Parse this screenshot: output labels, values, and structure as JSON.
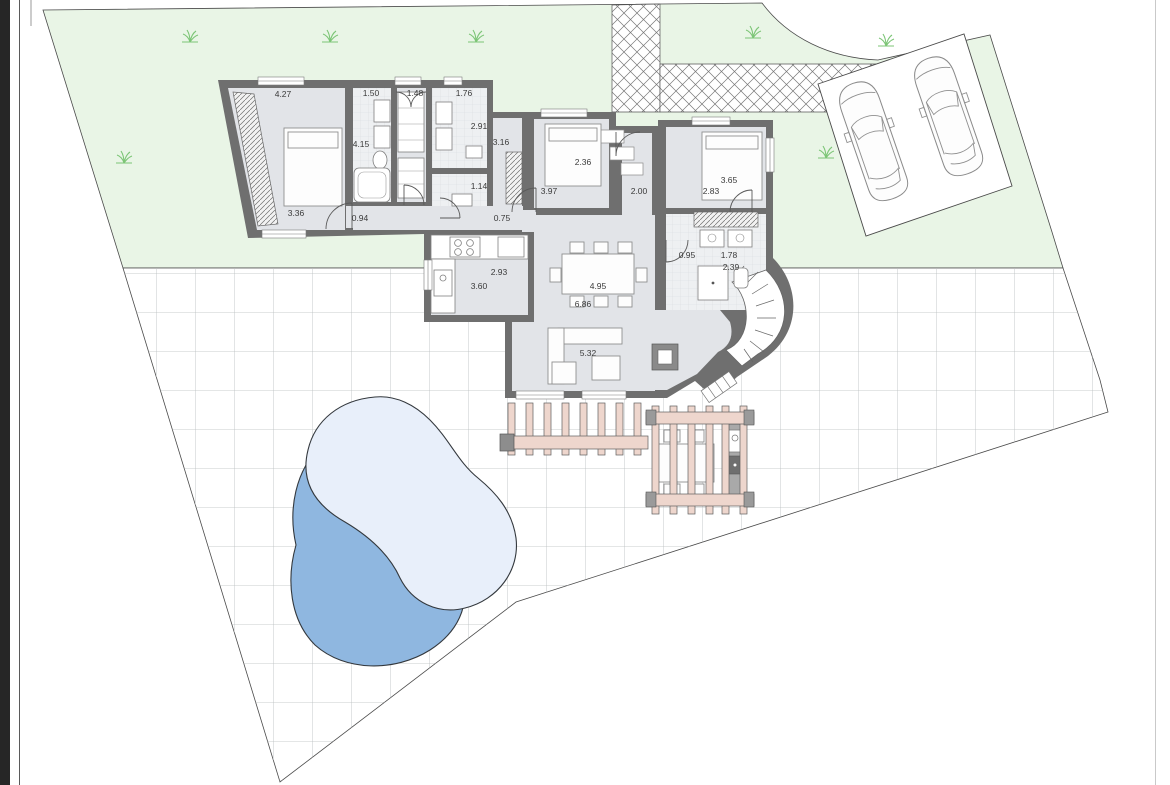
{
  "page": {
    "background": "#ffffff",
    "left_bar_color": "#262626"
  },
  "plan": {
    "type": "residential-site-plan-with-floor-plan",
    "colors": {
      "left_bar": "#262626",
      "wall": "#6f6f6f",
      "floor": "#e2e4e8",
      "lawn": "#e9f5e6",
      "pool_light": "#e8effa",
      "pool_dark": "#8fb7e0",
      "pergola": "#eed6cd",
      "grass": "#7cc576",
      "tile_line": "#b8bcbe",
      "boundary": "#4a4a4a"
    },
    "features": [
      "lawn",
      "paved-cross-hatch-path",
      "tiled-patio",
      "parking-pad",
      "two-cars",
      "swimming-pool",
      "pergola-left",
      "pergola-right-with-table",
      "bbq-grill",
      "house-floor-plan",
      "curved-outdoor-stair"
    ],
    "dimension_labels": [
      {
        "value": "4.27",
        "x": 283,
        "y": 97
      },
      {
        "value": "1.50",
        "x": 371,
        "y": 96
      },
      {
        "value": "1.48",
        "x": 415,
        "y": 96
      },
      {
        "value": "1.76",
        "x": 464,
        "y": 96
      },
      {
        "value": "4.15",
        "x": 361,
        "y": 147
      },
      {
        "value": "2.91",
        "x": 479,
        "y": 129
      },
      {
        "value": "3.16",
        "x": 501,
        "y": 145
      },
      {
        "value": "2.36",
        "x": 583,
        "y": 165
      },
      {
        "value": "3.97",
        "x": 549,
        "y": 194
      },
      {
        "value": "2.00",
        "x": 639,
        "y": 194
      },
      {
        "value": "3.65",
        "x": 729,
        "y": 183
      },
      {
        "value": "2.83",
        "x": 711,
        "y": 194
      },
      {
        "value": "3.36",
        "x": 296,
        "y": 216
      },
      {
        "value": "0.94",
        "x": 360,
        "y": 221
      },
      {
        "value": "1.14",
        "x": 479,
        "y": 189
      },
      {
        "value": "0.75",
        "x": 502,
        "y": 221
      },
      {
        "value": "0.95",
        "x": 687,
        "y": 258
      },
      {
        "value": "1.78",
        "x": 729,
        "y": 258
      },
      {
        "value": "2.39",
        "x": 731,
        "y": 270
      },
      {
        "value": "2.93",
        "x": 499,
        "y": 275
      },
      {
        "value": "3.60",
        "x": 479,
        "y": 289
      },
      {
        "value": "4.95",
        "x": 598,
        "y": 289
      },
      {
        "value": "6.86",
        "x": 583,
        "y": 307
      },
      {
        "value": "5.32",
        "x": 588,
        "y": 356
      }
    ]
  }
}
